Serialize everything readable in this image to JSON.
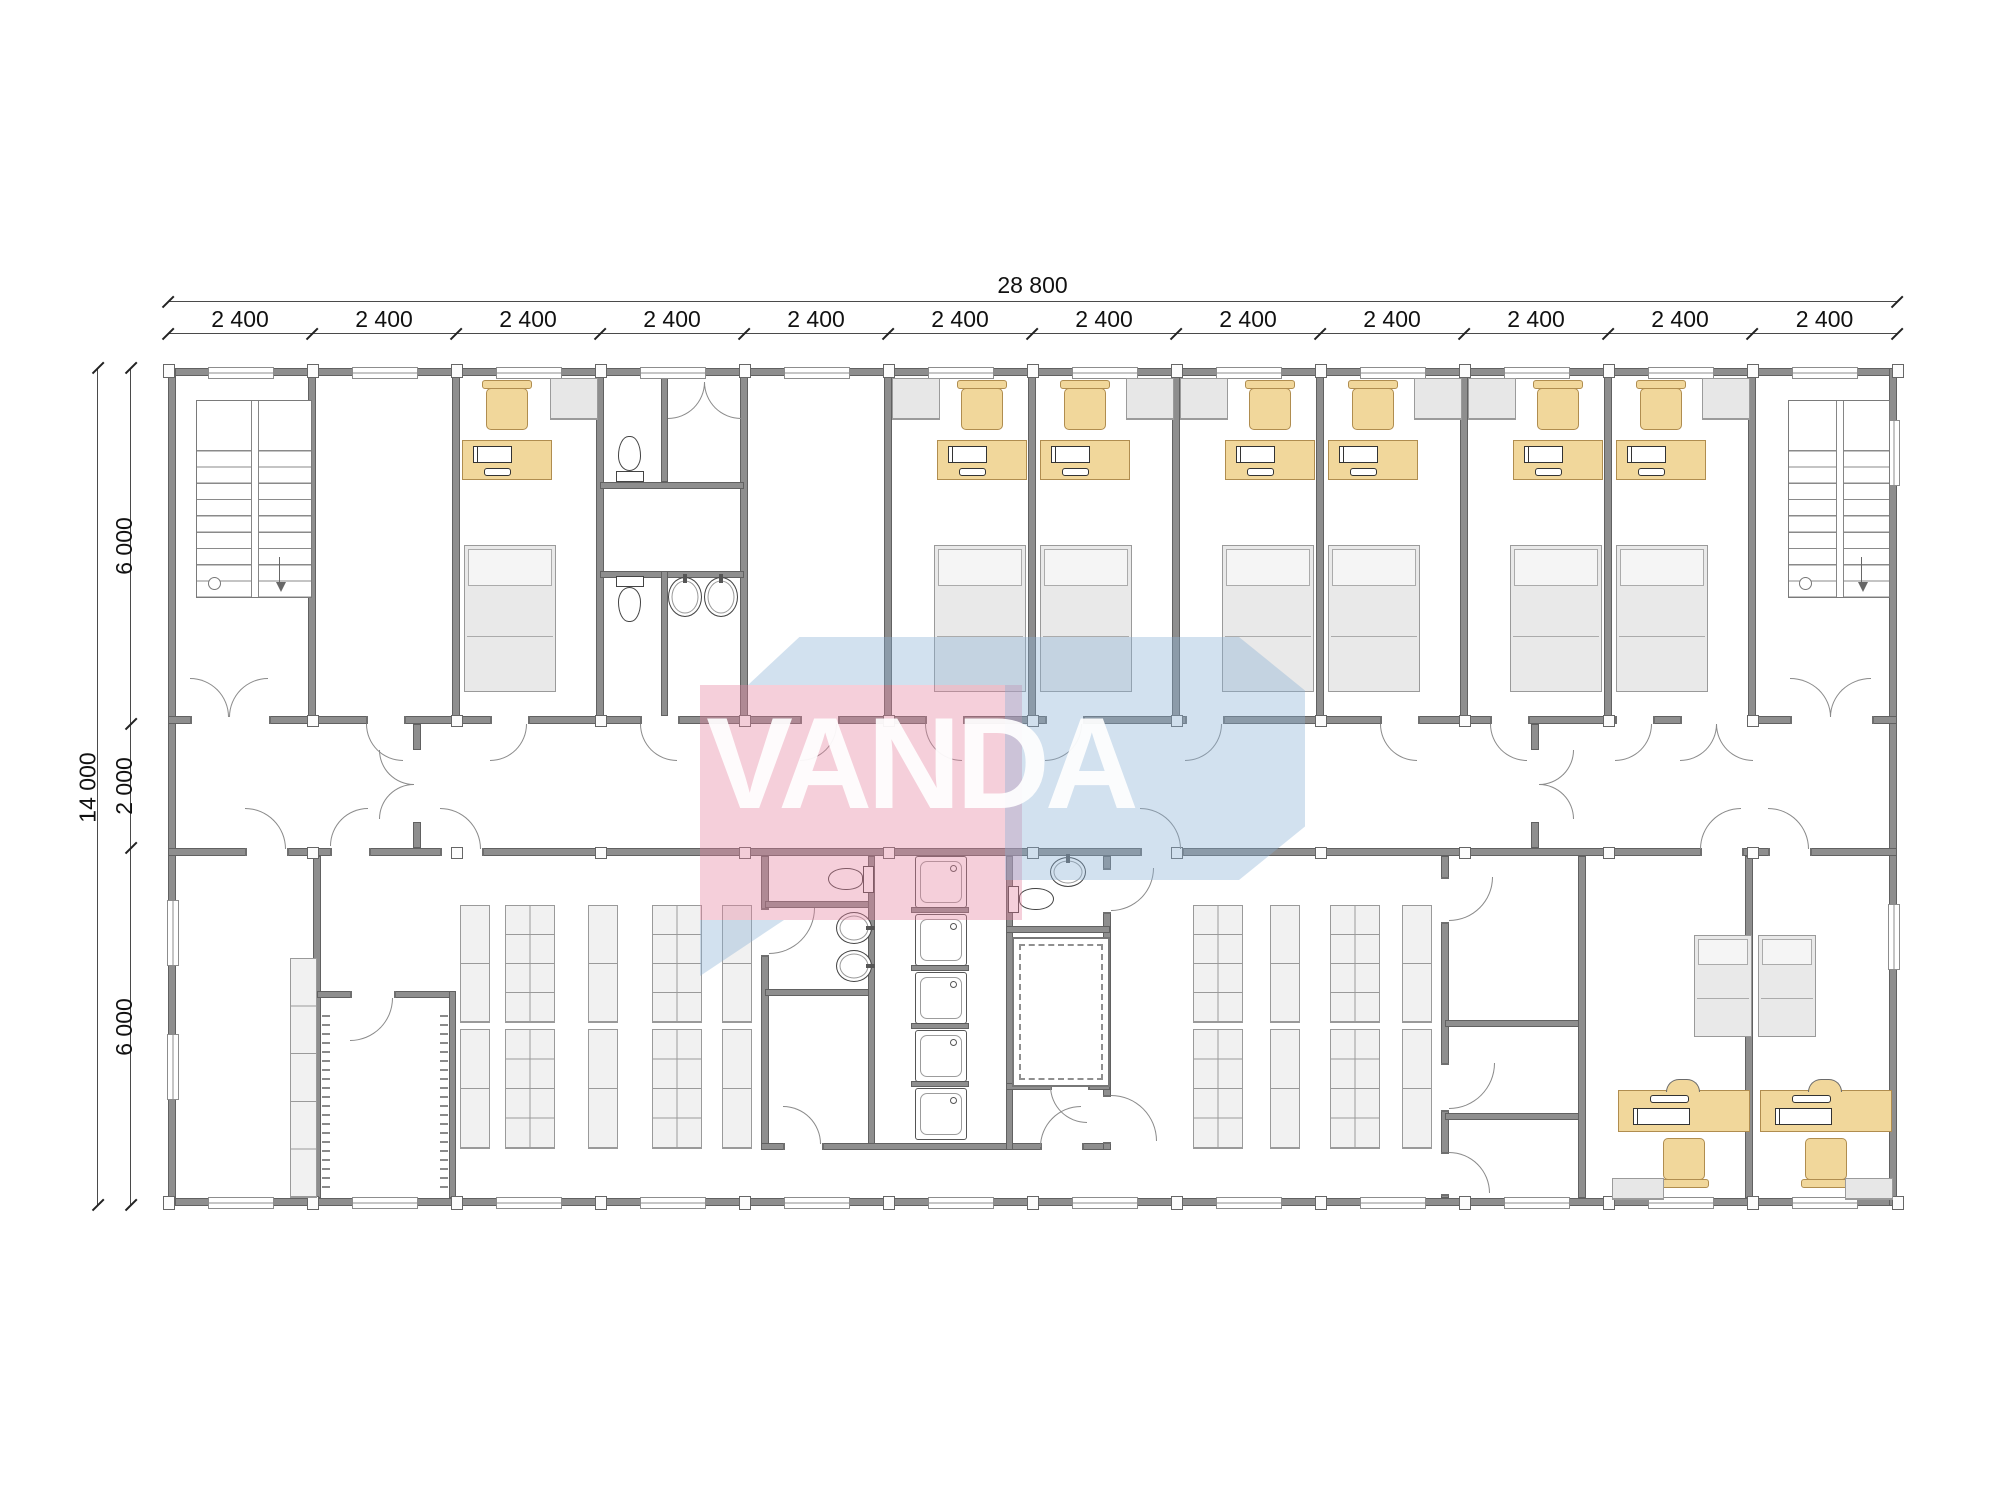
{
  "watermark": {
    "text": "VANDA",
    "pink_color": "rgba(228,128,158,0.38)",
    "blue_color": "rgba(138,176,212,0.38)",
    "text_color": "#ffffff"
  },
  "dimensions": {
    "total_width_label": "28 800",
    "bay_labels": [
      "2 400",
      "2 400",
      "2 400",
      "2 400",
      "2 400",
      "2 400",
      "2 400",
      "2 400",
      "2 400",
      "2 400",
      "2 400",
      "2 400"
    ],
    "total_height_label": "14 000",
    "height_segment_labels": [
      "6 000",
      "2 000",
      "6 000"
    ]
  },
  "colors": {
    "wall": "#8e8e8e",
    "wall_edge": "#616161",
    "furniture": "#f1d79b",
    "furniture_edge": "#b08d4f",
    "gray_fixture": "#e9e9e9",
    "dimension_text": "#111111"
  },
  "plan": {
    "bay_xs": [
      168,
      312,
      456,
      600,
      744,
      888,
      1032,
      1176,
      1320,
      1464,
      1608,
      1752,
      1897
    ],
    "band_ys": [
      368,
      724,
      848,
      1205
    ],
    "walls": [
      [
        168,
        368,
        1729,
        8
      ],
      [
        168,
        1198,
        1729,
        8
      ],
      [
        168,
        368,
        8,
        838
      ],
      [
        1889,
        368,
        8,
        838
      ],
      [
        168,
        716,
        1729,
        8
      ],
      [
        168,
        848,
        1729,
        8
      ],
      [
        308,
        375,
        8,
        341
      ],
      [
        452,
        375,
        8,
        341
      ],
      [
        596,
        375,
        8,
        341
      ],
      [
        740,
        375,
        8,
        341
      ],
      [
        884,
        375,
        8,
        341
      ],
      [
        1028,
        375,
        8,
        341
      ],
      [
        1172,
        375,
        8,
        341
      ],
      [
        1316,
        375,
        8,
        341
      ],
      [
        1460,
        375,
        8,
        341
      ],
      [
        1604,
        375,
        8,
        341
      ],
      [
        1748,
        375,
        8,
        341
      ],
      [
        661,
        375,
        7,
        107
      ],
      [
        600,
        482,
        144,
        7
      ],
      [
        600,
        571,
        144,
        7
      ],
      [
        661,
        571,
        7,
        145
      ],
      [
        413,
        724,
        8,
        26
      ],
      [
        413,
        822,
        8,
        26
      ],
      [
        1531,
        724,
        8,
        26
      ],
      [
        1531,
        822,
        8,
        26
      ],
      [
        313,
        856,
        8,
        342
      ],
      [
        317,
        991,
        139,
        7
      ],
      [
        449,
        991,
        7,
        207
      ],
      [
        761,
        856,
        8,
        294
      ],
      [
        765,
        901,
        108,
        7
      ],
      [
        765,
        989,
        108,
        7
      ],
      [
        868,
        856,
        7,
        294
      ],
      [
        761,
        1143,
        252,
        7
      ],
      [
        1010,
        1143,
        100,
        7
      ],
      [
        1006,
        856,
        7,
        294
      ],
      [
        1103,
        856,
        8,
        294
      ],
      [
        1006,
        926,
        104,
        7
      ],
      [
        1006,
        1083,
        104,
        7
      ],
      [
        911,
        907,
        58,
        6
      ],
      [
        911,
        965,
        58,
        6
      ],
      [
        911,
        1023,
        58,
        6
      ],
      [
        911,
        1081,
        58,
        6
      ],
      [
        1441,
        856,
        8,
        342
      ],
      [
        1445,
        1020,
        141,
        7
      ],
      [
        1445,
        1113,
        141,
        7
      ],
      [
        1578,
        856,
        8,
        342
      ],
      [
        1745,
        856,
        8,
        342
      ]
    ],
    "gaps": [
      [
        190,
        716,
        77,
        8
      ],
      [
        366,
        716,
        36,
        8
      ],
      [
        490,
        716,
        36,
        8
      ],
      [
        640,
        716,
        36,
        8
      ],
      [
        800,
        716,
        36,
        8
      ],
      [
        925,
        716,
        36,
        8
      ],
      [
        1045,
        716,
        36,
        8
      ],
      [
        1185,
        716,
        36,
        8
      ],
      [
        1380,
        716,
        36,
        8
      ],
      [
        1490,
        716,
        36,
        8
      ],
      [
        1615,
        716,
        36,
        8
      ],
      [
        1680,
        716,
        72,
        8
      ],
      [
        1790,
        716,
        80,
        8
      ],
      [
        245,
        848,
        40,
        8
      ],
      [
        330,
        848,
        37,
        8
      ],
      [
        440,
        848,
        40,
        8
      ],
      [
        1140,
        848,
        40,
        8
      ],
      [
        1700,
        848,
        40,
        8
      ],
      [
        1768,
        848,
        40,
        8
      ],
      [
        350,
        991,
        42,
        7
      ],
      [
        761,
        908,
        8,
        45
      ],
      [
        1103,
        868,
        8,
        42
      ],
      [
        1103,
        1095,
        8,
        45
      ],
      [
        783,
        1143,
        37,
        7
      ],
      [
        1040,
        1143,
        40,
        7
      ],
      [
        1050,
        1083,
        36,
        7
      ],
      [
        1441,
        877,
        8,
        43
      ],
      [
        1441,
        1063,
        8,
        45
      ],
      [
        1441,
        1152,
        8,
        40
      ]
    ],
    "windows": [
      [
        208,
        367,
        64,
        10
      ],
      [
        352,
        367,
        64,
        10
      ],
      [
        496,
        367,
        64,
        10
      ],
      [
        640,
        367,
        64,
        10
      ],
      [
        784,
        367,
        64,
        10
      ],
      [
        928,
        367,
        64,
        10
      ],
      [
        1072,
        367,
        64,
        10
      ],
      [
        1216,
        367,
        64,
        10
      ],
      [
        1360,
        367,
        64,
        10
      ],
      [
        1504,
        367,
        64,
        10
      ],
      [
        1648,
        367,
        64,
        10
      ],
      [
        1792,
        367,
        64,
        10
      ],
      [
        208,
        1197,
        64,
        10
      ],
      [
        352,
        1197,
        64,
        10
      ],
      [
        496,
        1197,
        64,
        10
      ],
      [
        640,
        1197,
        64,
        10
      ],
      [
        784,
        1197,
        64,
        10
      ],
      [
        928,
        1197,
        64,
        10
      ],
      [
        1072,
        1197,
        64,
        10
      ],
      [
        1216,
        1197,
        64,
        10
      ],
      [
        1360,
        1197,
        64,
        10
      ],
      [
        1504,
        1197,
        64,
        10
      ],
      [
        1648,
        1197,
        64,
        10
      ],
      [
        1792,
        1197,
        64,
        10
      ],
      [
        167,
        900,
        10,
        64
      ],
      [
        167,
        1034,
        10,
        64
      ],
      [
        1888,
        420,
        10,
        64
      ],
      [
        1888,
        904,
        10,
        64
      ]
    ],
    "doors": [
      [
        366,
        724,
        36,
        36,
        "tr"
      ],
      [
        490,
        724,
        36,
        36,
        "tl"
      ],
      [
        640,
        724,
        36,
        36,
        "tr"
      ],
      [
        800,
        724,
        36,
        36,
        "tl"
      ],
      [
        925,
        724,
        36,
        36,
        "tr"
      ],
      [
        1045,
        724,
        36,
        36,
        "tl"
      ],
      [
        1185,
        724,
        36,
        36,
        "tl"
      ],
      [
        1380,
        724,
        36,
        36,
        "tr"
      ],
      [
        1490,
        724,
        36,
        36,
        "tr"
      ],
      [
        1615,
        724,
        36,
        36,
        "tl"
      ],
      [
        1680,
        724,
        36,
        36,
        "tl"
      ],
      [
        1716,
        724,
        36,
        36,
        "tr"
      ],
      [
        190,
        678,
        38,
        38,
        "bl"
      ],
      [
        229,
        678,
        38,
        38,
        "br"
      ],
      [
        1790,
        678,
        40,
        38,
        "bl"
      ],
      [
        1830,
        678,
        40,
        38,
        "br"
      ],
      [
        245,
        808,
        40,
        40,
        "bl"
      ],
      [
        330,
        808,
        37,
        37,
        "br"
      ],
      [
        440,
        808,
        40,
        40,
        "bl"
      ],
      [
        1140,
        808,
        40,
        40,
        "bl"
      ],
      [
        1700,
        808,
        40,
        40,
        "br"
      ],
      [
        1768,
        808,
        40,
        40,
        "bl"
      ],
      [
        379,
        750,
        34,
        34,
        "tr"
      ],
      [
        379,
        784,
        34,
        34,
        "br"
      ],
      [
        1539,
        750,
        34,
        34,
        "tl"
      ],
      [
        1539,
        784,
        34,
        34,
        "bl"
      ],
      [
        350,
        998,
        42,
        42,
        "tl"
      ],
      [
        668,
        382,
        36,
        36,
        "tl"
      ],
      [
        704,
        382,
        36,
        36,
        "tr"
      ],
      [
        769,
        908,
        45,
        45,
        "tl"
      ],
      [
        783,
        1106,
        37,
        37,
        "bl"
      ],
      [
        1040,
        1106,
        40,
        40,
        "br"
      ],
      [
        1050,
        1086,
        36,
        36,
        "tr"
      ],
      [
        1111,
        868,
        42,
        42,
        "tl"
      ],
      [
        1111,
        1095,
        45,
        45,
        "bl"
      ],
      [
        1449,
        877,
        43,
        43,
        "tl"
      ],
      [
        1449,
        1063,
        45,
        45,
        "tl"
      ],
      [
        1449,
        1152,
        40,
        40,
        "bl"
      ]
    ],
    "fixtures": [
      [
        "st",
        196,
        400,
        114,
        196
      ],
      [
        "st",
        1788,
        400,
        100,
        196
      ],
      [
        "dk",
        462,
        440,
        88,
        38
      ],
      [
        "dk",
        937,
        440,
        88,
        38
      ],
      [
        "dk",
        1040,
        440,
        88,
        38
      ],
      [
        "dk",
        1225,
        440,
        88,
        38
      ],
      [
        "dk",
        1328,
        440,
        88,
        38
      ],
      [
        "dk",
        1513,
        440,
        88,
        38
      ],
      [
        "dk",
        1616,
        440,
        88,
        38
      ],
      [
        "ch",
        486,
        388,
        40,
        40
      ],
      [
        "ch",
        961,
        388,
        40,
        40
      ],
      [
        "ch",
        1064,
        388,
        40,
        40
      ],
      [
        "ch",
        1249,
        388,
        40,
        40
      ],
      [
        "ch",
        1352,
        388,
        40,
        40
      ],
      [
        "ch",
        1537,
        388,
        40,
        40
      ],
      [
        "ch",
        1640,
        388,
        40,
        40
      ],
      [
        "bd",
        464,
        545,
        90,
        145
      ],
      [
        "bd",
        934,
        545,
        90,
        145
      ],
      [
        "bd",
        1040,
        545,
        90,
        145
      ],
      [
        "bd",
        1222,
        545,
        90,
        145
      ],
      [
        "bd",
        1328,
        545,
        90,
        145
      ],
      [
        "bd",
        1510,
        545,
        90,
        145
      ],
      [
        "bd",
        1616,
        545,
        90,
        145
      ],
      [
        "cb",
        550,
        378,
        46,
        40
      ],
      [
        "cb",
        892,
        378,
        46,
        40
      ],
      [
        "cb",
        1126,
        378,
        46,
        40
      ],
      [
        "cb",
        1180,
        378,
        46,
        40
      ],
      [
        "cb",
        1414,
        378,
        46,
        40
      ],
      [
        "cb",
        1468,
        378,
        46,
        40
      ],
      [
        "cb",
        1702,
        378,
        46,
        40
      ],
      [
        "wcs",
        612,
        434,
        36,
        48
      ],
      [
        "wcn",
        612,
        576,
        36,
        48
      ],
      [
        "wce",
        826,
        862,
        48,
        34
      ],
      [
        "wcw",
        1008,
        882,
        48,
        34
      ],
      [
        "bn",
        668,
        577,
        32,
        38
      ],
      [
        "bn",
        704,
        577,
        32,
        38
      ],
      [
        "bn",
        1050,
        857,
        34,
        28
      ],
      [
        "be",
        836,
        912,
        34,
        30
      ],
      [
        "be",
        836,
        950,
        34,
        30
      ],
      [
        "sh",
        915,
        856,
        50,
        50
      ],
      [
        "sh",
        915,
        914,
        50,
        50
      ],
      [
        "sh",
        915,
        972,
        50,
        50
      ],
      [
        "sh",
        915,
        1030,
        50,
        50
      ],
      [
        "sh",
        915,
        1088,
        50,
        50
      ],
      [
        "sa",
        1012,
        937,
        94,
        146
      ],
      [
        "rk",
        460,
        905,
        28,
        116,
        1,
        2
      ],
      [
        "rk",
        460,
        1029,
        28,
        118,
        1,
        2
      ],
      [
        "rk",
        505,
        905,
        48,
        116,
        2,
        4
      ],
      [
        "rk",
        505,
        1029,
        48,
        118,
        2,
        4
      ],
      [
        "rk",
        588,
        905,
        28,
        116,
        1,
        2
      ],
      [
        "rk",
        588,
        1029,
        28,
        118,
        1,
        2
      ],
      [
        "rk",
        652,
        905,
        48,
        116,
        2,
        4
      ],
      [
        "rk",
        652,
        1029,
        48,
        118,
        2,
        4
      ],
      [
        "rk",
        722,
        905,
        28,
        116,
        1,
        2
      ],
      [
        "rk",
        722,
        1029,
        28,
        118,
        1,
        2
      ],
      [
        "rk",
        1193,
        905,
        48,
        116,
        2,
        4
      ],
      [
        "rk",
        1193,
        1029,
        48,
        118,
        2,
        4
      ],
      [
        "rk",
        1270,
        905,
        28,
        116,
        1,
        2
      ],
      [
        "rk",
        1270,
        1029,
        28,
        118,
        1,
        2
      ],
      [
        "rk",
        1330,
        905,
        48,
        116,
        2,
        4
      ],
      [
        "rk",
        1330,
        1029,
        48,
        118,
        2,
        4
      ],
      [
        "rk",
        1402,
        905,
        28,
        116,
        1,
        2
      ],
      [
        "rk",
        1402,
        1029,
        28,
        118,
        1,
        2
      ],
      [
        "rk",
        290,
        958,
        25,
        238,
        1,
        5
      ],
      [
        "tk",
        322,
        1015,
        8,
        175
      ],
      [
        "tk",
        440,
        1015,
        8,
        175
      ],
      [
        "bd",
        1694,
        935,
        56,
        100
      ],
      [
        "bd",
        1758,
        935,
        56,
        100
      ],
      [
        "dks",
        1618,
        1090,
        130,
        40
      ],
      [
        "dks",
        1760,
        1090,
        130,
        40
      ],
      [
        "chs",
        1663,
        1138,
        40,
        40
      ],
      [
        "chs",
        1805,
        1138,
        40,
        40
      ],
      [
        "cb",
        1612,
        1178,
        50,
        20
      ],
      [
        "cb",
        1845,
        1178,
        46,
        20
      ]
    ]
  }
}
